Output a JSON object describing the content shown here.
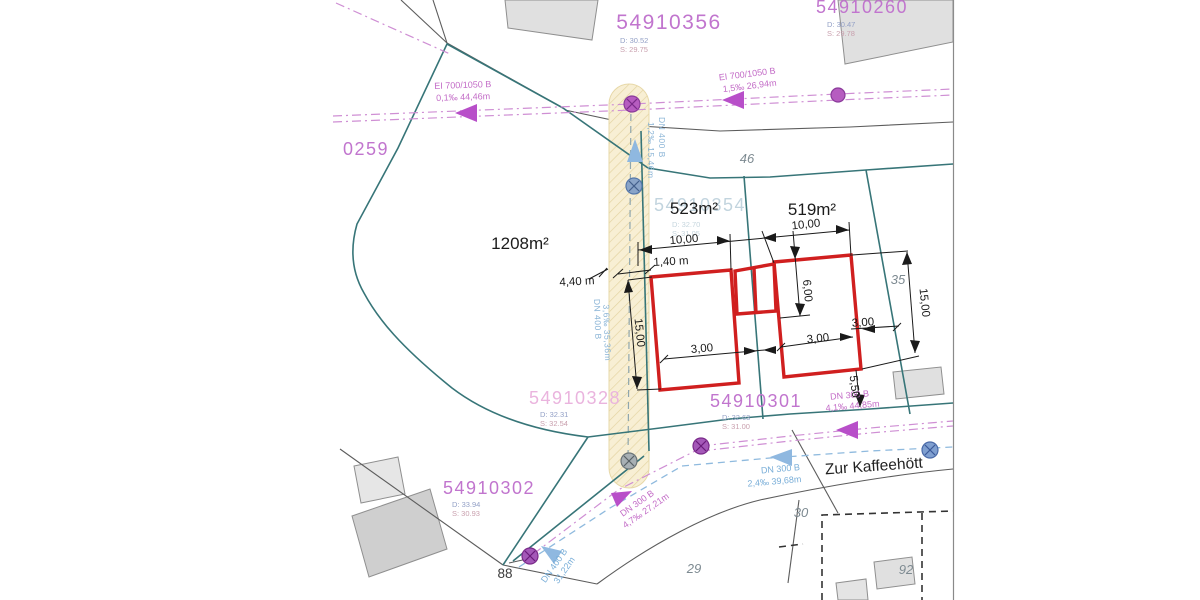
{
  "parcels": [
    {
      "id": "54910356",
      "d": "D: 30.52",
      "s": "S: 29.75"
    },
    {
      "id": "54910260",
      "d": "D: 30.47",
      "s": "S: 29.78"
    },
    {
      "id": "0259"
    },
    {
      "id": "54910354",
      "d": "D: 32.70",
      "s": "S: 31.05"
    },
    {
      "id": "54910328",
      "d": "D: 32.31",
      "s": "S: 32.54"
    },
    {
      "id": "54910301",
      "d": "D: 32.63",
      "s": "S: 31.00"
    },
    {
      "id": "54910302",
      "d": "D: 33.94",
      "s": "S: 30.93"
    }
  ],
  "areas": {
    "parcel_large": "1208m²",
    "parcel_left": "523m²",
    "parcel_right": "519m²"
  },
  "house_numbers": {
    "n46": "46",
    "n35": "35",
    "n30": "30",
    "n29": "29",
    "n92": "92",
    "n88": "88"
  },
  "street_name": "Zur Kaffeehött",
  "utilities": {
    "sewer_nw": {
      "l1": "EI 700/1050 B",
      "l2": "0,1‰ 44,46m"
    },
    "sewer_ne": {
      "l1": "EI 700/1050 B",
      "l2": "1,5‰ 26,94m"
    },
    "sewer_street": {
      "l1": "DN 300 B",
      "l2": "4,1‰ 44,85m"
    },
    "water_street": {
      "l1": "DN 300 B",
      "l2": "2,4‰ 39,68m"
    },
    "sewer_slope": {
      "l1": "DN 300 B",
      "l2": "4,7‰ 27,21m"
    },
    "water_slope": {
      "l1": "DN 400 B",
      "l2": "31,22m"
    },
    "water_strip_upper": {
      "l1": "DN 400 B",
      "l2": "1,2‰ 15,46m"
    },
    "water_strip_lower": {
      "l1": "DN 400 B",
      "l2": "3,6‰ 35,36m"
    }
  },
  "dimensions": {
    "width_left": "10,00",
    "width_right": "10,00",
    "offset_strip": "1,40 m",
    "offset_road": "4,40 m",
    "depth_left": "15,00",
    "depth_right": "15,00",
    "gap_left": "3,00",
    "gap_mid": "3,00",
    "gap_right": "3,00",
    "depth_house": "6,00",
    "setback": "5,50"
  },
  "colors": {
    "parcel_boundary": "#377578",
    "parcel_label": "#c175ce",
    "sewer": "#c977cf",
    "water": "#7fb2dc",
    "building_outline": "#d01f1f",
    "corridor_fill": "#f8efd4",
    "dimension": "#1a1a1a"
  }
}
